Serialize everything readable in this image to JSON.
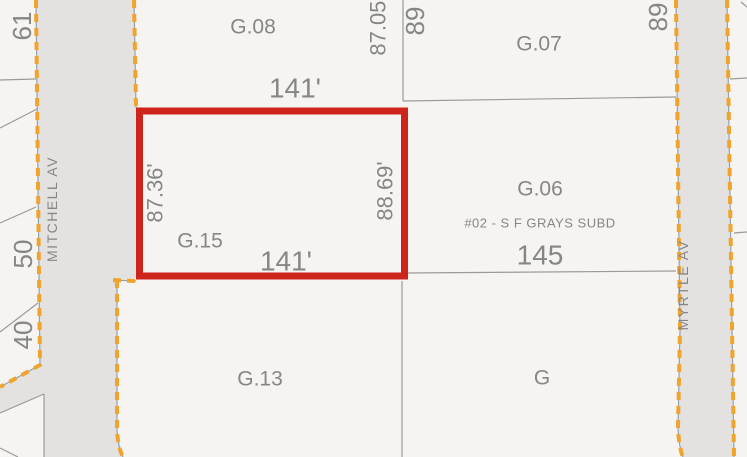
{
  "colors": {
    "parcel_fill": "#f5f4f1",
    "road_fill": "#e3e2e0",
    "boundary_line": "#9a9a98",
    "dashed_edge": "#f0a42c",
    "highlight": "#cd241b",
    "subdivision": "#9c7544"
  },
  "streets": {
    "mitchell": "MITCHELL AV",
    "myrtle": "MYRTLE AV"
  },
  "parcels": {
    "g08": "G.08",
    "g07": "G.07",
    "g06": "G.06",
    "g15": "G.15",
    "g13": "G.13",
    "g": "G"
  },
  "numbers": {
    "n61": "61",
    "n50": "50",
    "n40": "40",
    "n89_west": "89",
    "n89_east": "89",
    "n145": "145"
  },
  "dimensions": {
    "g15_top": "141'",
    "g15_bottom": "141'",
    "g15_left": "87.36'",
    "g15_right": "88.69'",
    "g08_east": "87.05'"
  },
  "subdivision": "#02 - S F GRAYS SUBD"
}
